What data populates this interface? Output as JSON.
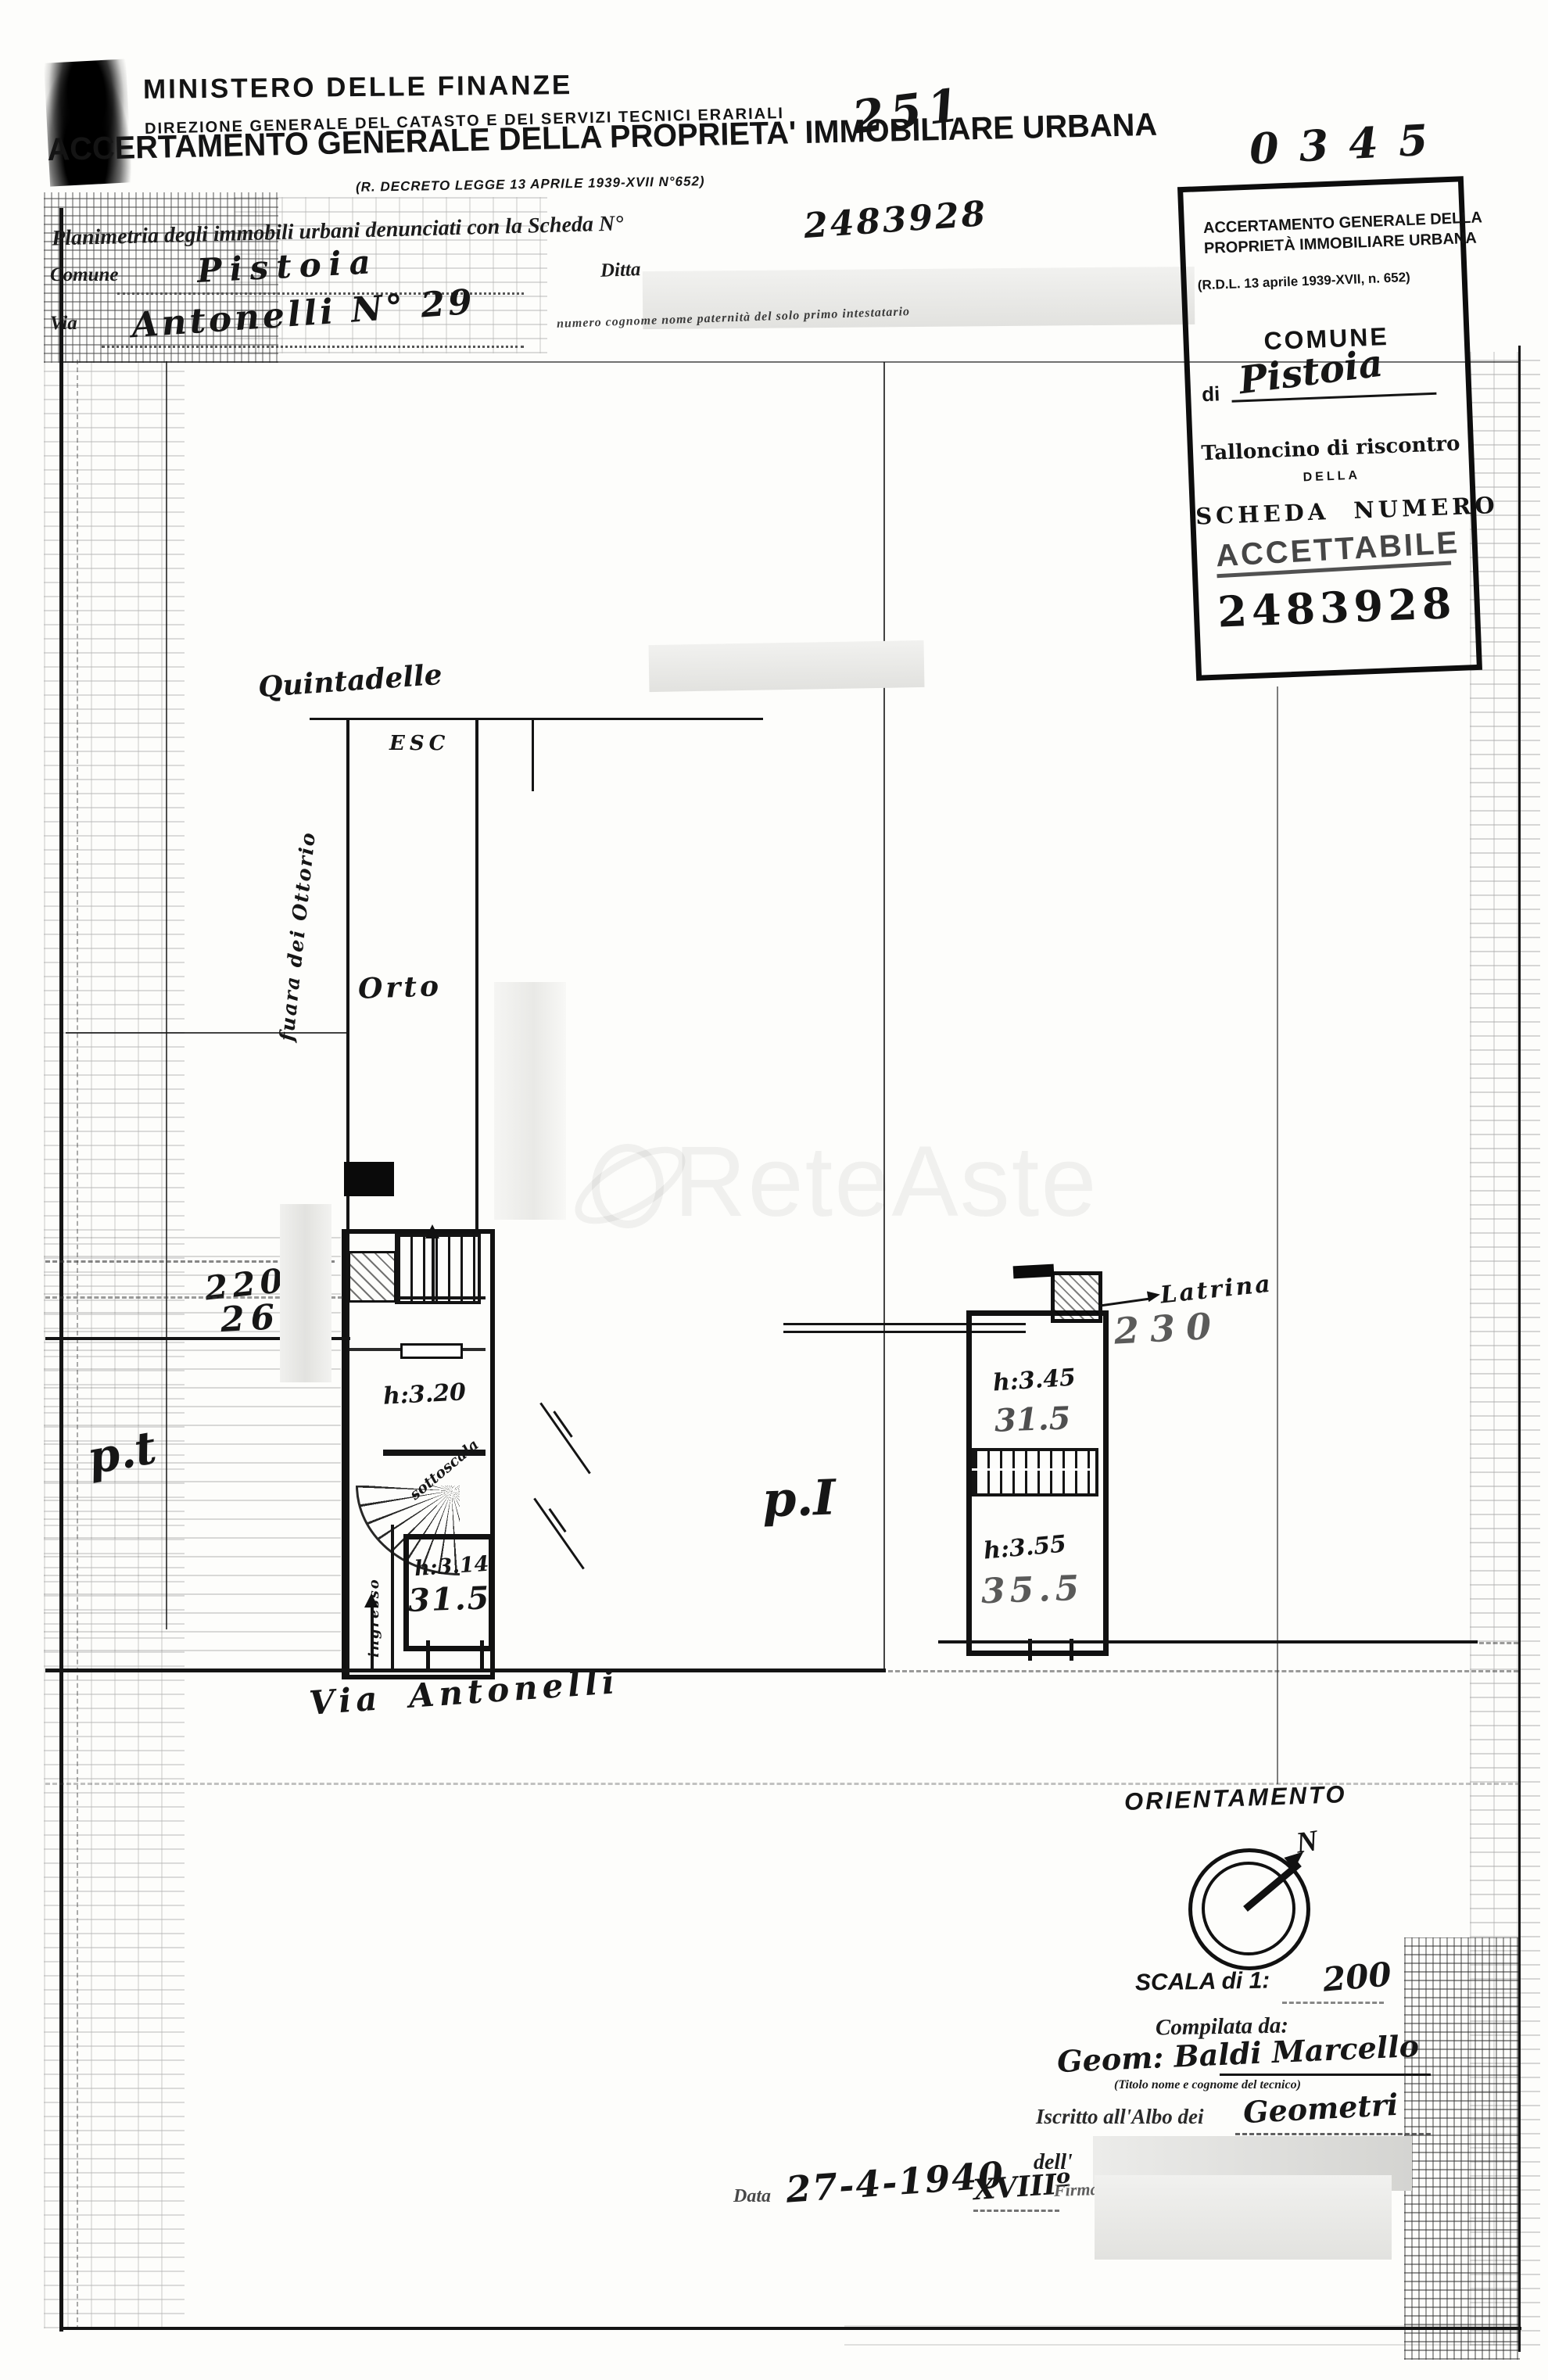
{
  "header": {
    "ministry": "MINISTERO DELLE FINANZE",
    "directorate": "DIREZIONE GENERALE DEL CATASTO E DEI SERVIZI TECNICI ERARIALI",
    "protocol_number": "251",
    "title": "ACCERTAMENTO GENERALE DELLA PROPRIETA' IMMOBILIARE URBANA",
    "decree": "(R. DECRETO LEGGE 13 APRILE 1939-XVII N°652)"
  },
  "form": {
    "planimetria_text": "Planimetria degli immobili urbani denunciati con la Scheda N°",
    "scheda_number": "2483928",
    "comune_label": "Comune",
    "comune_value": "Pistoia",
    "ditta_label": "Ditta",
    "via_label": "Via",
    "via_value": "Antonelli N° 29",
    "intestatario_note": "numero cognome nome paternità del solo primo intestatario"
  },
  "stamp": {
    "handwritten_number": "0345",
    "title_line1": "ACCERTAMENTO GENERALE DELLA",
    "title_line2": "PROPRIETÀ IMMOBILIARE URBANA",
    "decree": "(R.D.L. 13 aprile 1939-XVII, n. 652)",
    "comune_heading": "COMUNE",
    "di_label": "di",
    "comune_value": "Pistoia",
    "talloncino_line": "Talloncino di riscontro",
    "della_label": "DELLA",
    "scheda_numero_label": "SCHEDA NUMERO",
    "accettabile_stamp": "ACCETTABILE",
    "scheda_number": "2483928"
  },
  "plan": {
    "top_label": "Quintadelle",
    "esc_label": "ESC",
    "orto_label": "Orto",
    "side_street_label": "fuara dei Ottorio",
    "dim_220": "220",
    "dim_260": "260",
    "dim_230": "230",
    "room_gf_height": "h:3.20",
    "sottoscala_label": "sottoscala",
    "ingresso_label": "ingresso",
    "room_gf2_height": "h:3.14",
    "room_gf2_area": "31.5",
    "floor_gf_label": "p.t",
    "floor_f1_label": "p.I",
    "street_label": "Via Antonelli",
    "latrina_label": "Latrina",
    "room_f1a_height": "h:3.45",
    "room_f1a_area": "31.5",
    "room_f1b_height": "h:3.55",
    "room_f1b_area": "35.5"
  },
  "footer": {
    "orientamento_label": "ORIENTAMENTO",
    "north_label": "N",
    "scala_label": "SCALA di 1:",
    "scala_value": "200",
    "compilata_label": "Compilata da:",
    "tecnico_value": "Geom: Baldi Marcello",
    "tecnico_note": "(Titolo nome e cognome del tecnico)",
    "albo_text": "Iscritto all'Albo dei",
    "albo_value": "Geometri",
    "provincia_fragment": "dell'",
    "data_label": "Data",
    "data_value": "27-4-1940",
    "era_value": "XVIIIº",
    "firma_label": "Firma"
  },
  "watermark": {
    "text": "ReteAste"
  }
}
